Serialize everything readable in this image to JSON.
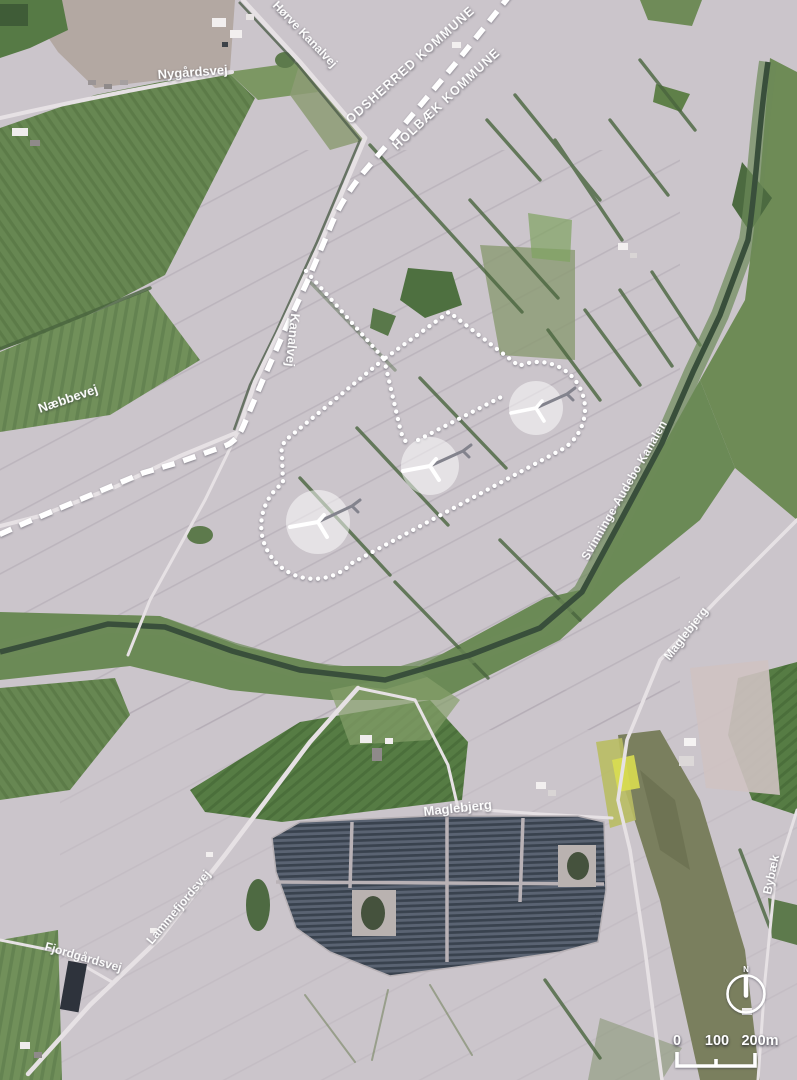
{
  "boundary": {
    "odsherred": "ODSHERRED KOMMUNE",
    "holbaek": "HOLBÆK KOMMUNE"
  },
  "labels": {
    "hoerve_kanalvej": "Hørve Kanalvej",
    "nygaardsvej": "Nygårdsvej",
    "kanalvej": "Kanalvej",
    "naebbevej": "Næbbevej",
    "svinninge_audebo": "Svinninge-Audebo Kanalen",
    "maglebjerg_east": "Maglebjerg",
    "maglebjerg_central": "Maglebjerg",
    "lammefjordsvej": "Lammefjordsvej",
    "fjordgaardsvej": "Fjordgårdsvej",
    "bybaek": "Bybæk"
  },
  "scale_bar": {
    "tick0": "0",
    "tick100": "100",
    "tick200": "200m"
  },
  "compass": {
    "north": "N"
  },
  "project_overlay": {
    "turbine_count": 3,
    "outline_style": "dotted-white",
    "boundary_style": "dashed-white"
  },
  "colors": {
    "field_base": "#cbc5cb",
    "field_green": "#678752",
    "canal_water": "#394f3b",
    "solar_panels": "#4a5260",
    "overlay_white": "#ffffff"
  }
}
